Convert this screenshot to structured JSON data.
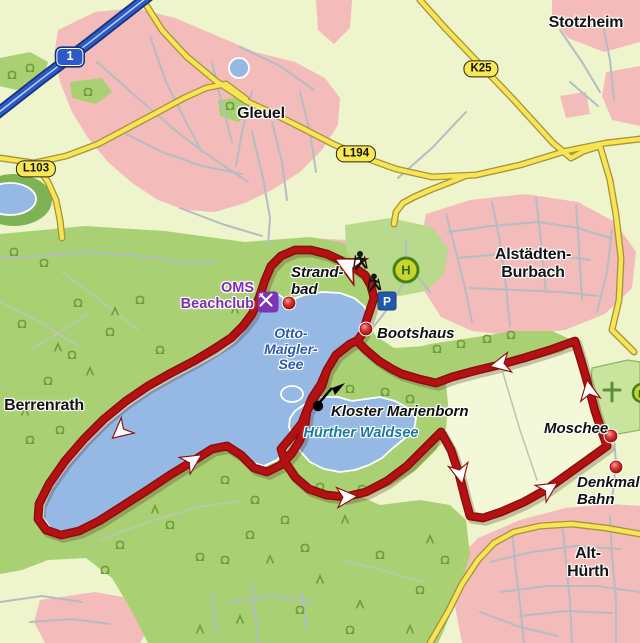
{
  "map_title": "Rundweg Otto-Maigler-See",
  "towns": [
    {
      "label": "Gleuel",
      "x": 261,
      "y": 105
    },
    {
      "label": "Stotzheim",
      "x": 586,
      "y": 14
    },
    {
      "label": "Alstädten-\nBurbach",
      "x": 533,
      "y": 246
    },
    {
      "label": "Berrenrath",
      "x": 44,
      "y": 397
    },
    {
      "label": "Alt-Hürth",
      "x": 588,
      "y": 545
    }
  ],
  "pois": [
    {
      "label": "Strand-\nbad",
      "x": 291,
      "y": 265,
      "dot": {
        "x": 289,
        "y": 303
      }
    },
    {
      "label": "Bootshaus",
      "x": 377,
      "y": 326,
      "dot": {
        "x": 366,
        "y": 329
      }
    },
    {
      "label": "Kloster Marienborn",
      "x": 331,
      "y": 404
    },
    {
      "label": "Moschee",
      "x": 544,
      "y": 421,
      "dot": {
        "x": 611,
        "y": 436
      }
    },
    {
      "label": "Denkmal-\nBahn",
      "x": 577,
      "y": 475,
      "dot": {
        "x": 616,
        "y": 467
      }
    }
  ],
  "lakes": [
    {
      "label": "Otto-\nMaigler-\nSee",
      "x": 291,
      "y": 326
    },
    {
      "label": "Hürther Waldsee",
      "x": 361,
      "y": 425
    }
  ],
  "beachclub": {
    "label": "OMS\nBeachclub",
    "x": 254,
    "y": 280
  },
  "shields": [
    {
      "name": "motorway-1",
      "label": "1",
      "x": 70,
      "y": 57,
      "type": "motorway"
    },
    {
      "name": "l103",
      "label": "L103",
      "x": 36,
      "y": 169,
      "type": "road"
    },
    {
      "name": "l194",
      "label": "L194",
      "x": 356,
      "y": 154,
      "type": "road"
    },
    {
      "name": "k25",
      "label": "K25",
      "x": 481,
      "y": 69,
      "type": "road"
    }
  ],
  "markers": {
    "parking": {
      "label": "P",
      "x": 387,
      "y": 301
    },
    "bus_stop": {
      "label": "H",
      "x": 406,
      "y": 270
    },
    "restaurant": {
      "x": 268,
      "y": 302
    },
    "hikers": {
      "x": 366,
      "y": 271
    },
    "kloster_flag": {
      "x": 318,
      "y": 406
    }
  },
  "colors": {
    "route_red": "#b41113",
    "water": "#95b9e4",
    "forest": "#a9d173",
    "residential_pink": "#f3bcba",
    "road_yellow": "#f7e554",
    "motorway_blue": "#2e5ac6",
    "base": "#eef5cd"
  }
}
